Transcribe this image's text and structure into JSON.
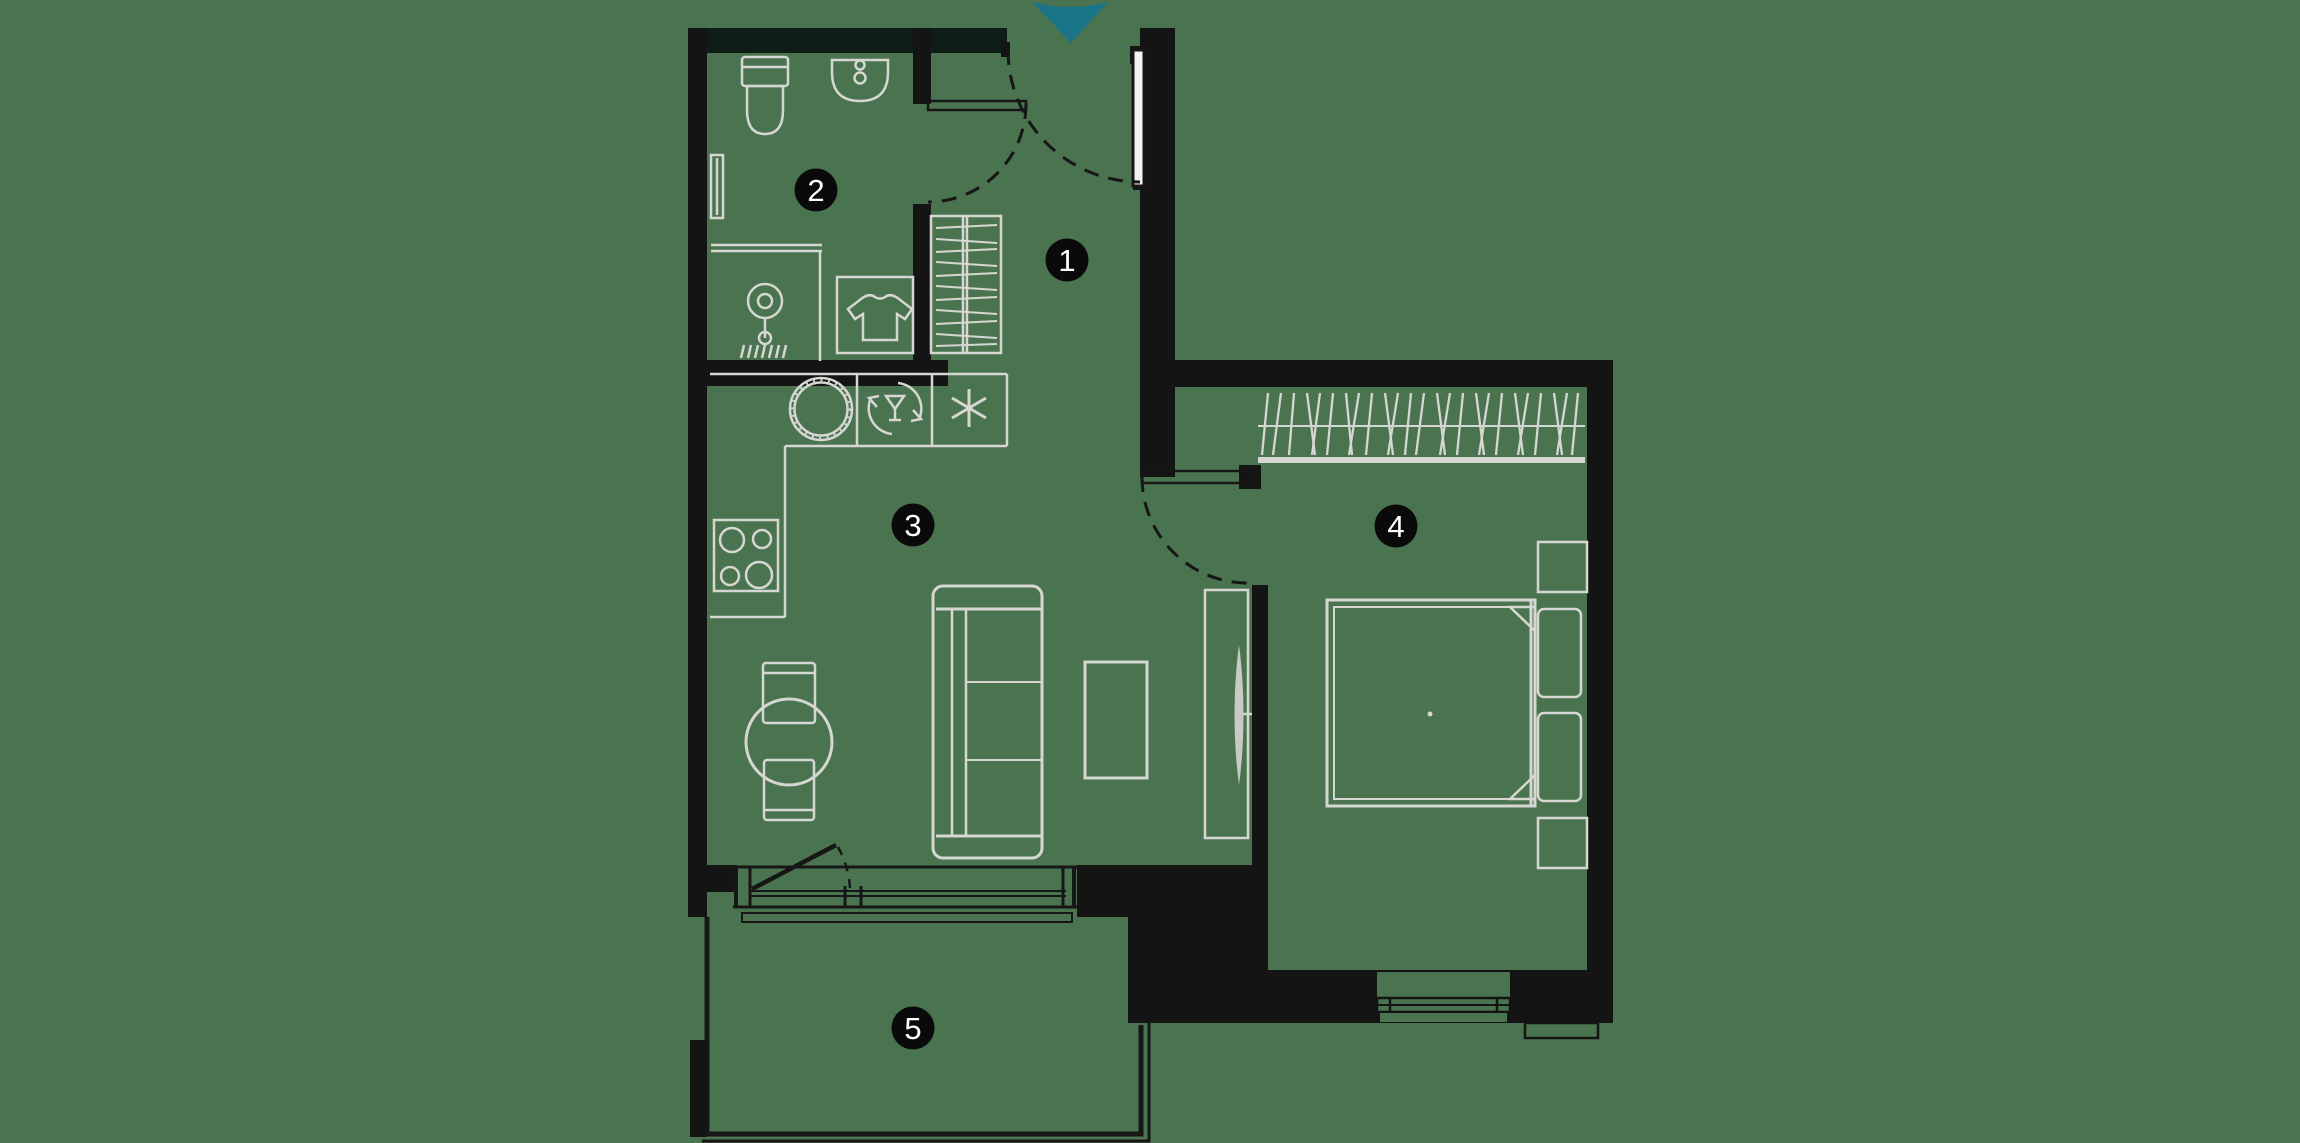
{
  "floorplan": {
    "type": "apartment-floor-plan",
    "room_labels": [
      "1",
      "2",
      "3",
      "4",
      "5"
    ],
    "colors": {
      "background": "#4a744f",
      "walls": "#141414",
      "outer_top_wall": "#0e1d18",
      "furniture_line": "#d6d6d2",
      "door_line": "#161616",
      "entrance_arrow": "#1a7589",
      "label_background": "#0a0a0a",
      "label_text": "#ffffff"
    },
    "icons": {
      "entrance-arrow-icon": "triangle-down",
      "toilet-icon": "toilet",
      "washbasin-icon": "half-oval-basin",
      "shower-icon": "shower-head-and-drain",
      "washing-machine-icon": "square-with-tshirt",
      "tshirt-icon": "t-shirt",
      "kitchen-sink-icon": "ticked-circle",
      "dishwasher-icon": "wine-glass-in-circular-arrows",
      "fridge-snowflake-icon": "asterisk-snowflake",
      "stove-icon": "four-burners",
      "hanger-rail-icon": "hatched-rail",
      "tv-icon": "lens-on-wall",
      "bed-icon": "double-bed-with-pillows",
      "sofa-icon": "sofa",
      "dining-table-icon": "round-table-two-chairs"
    }
  }
}
